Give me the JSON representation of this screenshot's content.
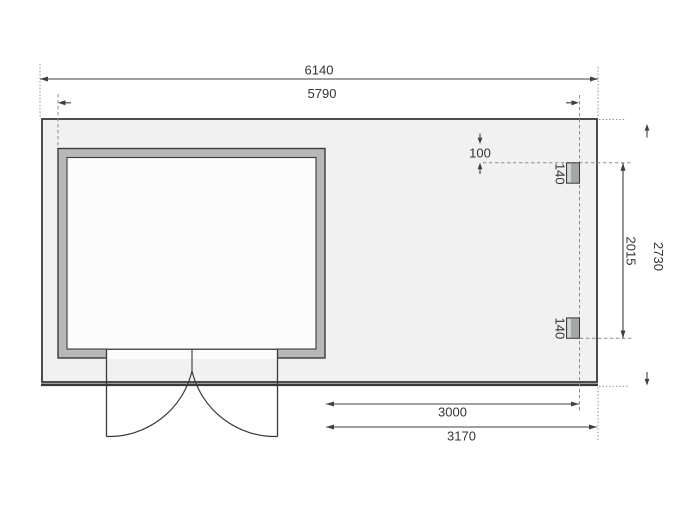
{
  "drawing": {
    "kind": "garden-house floor plan with annex, double doors and two posts",
    "colors": {
      "background": "#ffffff",
      "line": "#3a3a3a",
      "dim": "#404040",
      "dash": "#8c8c8c",
      "platform_fill": "#f1f1f2",
      "wall_fill": "#b7b9b9",
      "interior_fill": "#fcfcfc",
      "post_fill": "#a4a7a7",
      "post_stripe": "#d3d5d5",
      "text": "#333333"
    },
    "dims": {
      "total_width": "6140",
      "body_width": "5790",
      "offset_small": "100",
      "post_size_top": "140",
      "post_size_bottom": "140",
      "post_spacing": "2015",
      "total_depth": "2730",
      "annex_inner_width": "3000",
      "annex_outer_width": "3170"
    }
  }
}
